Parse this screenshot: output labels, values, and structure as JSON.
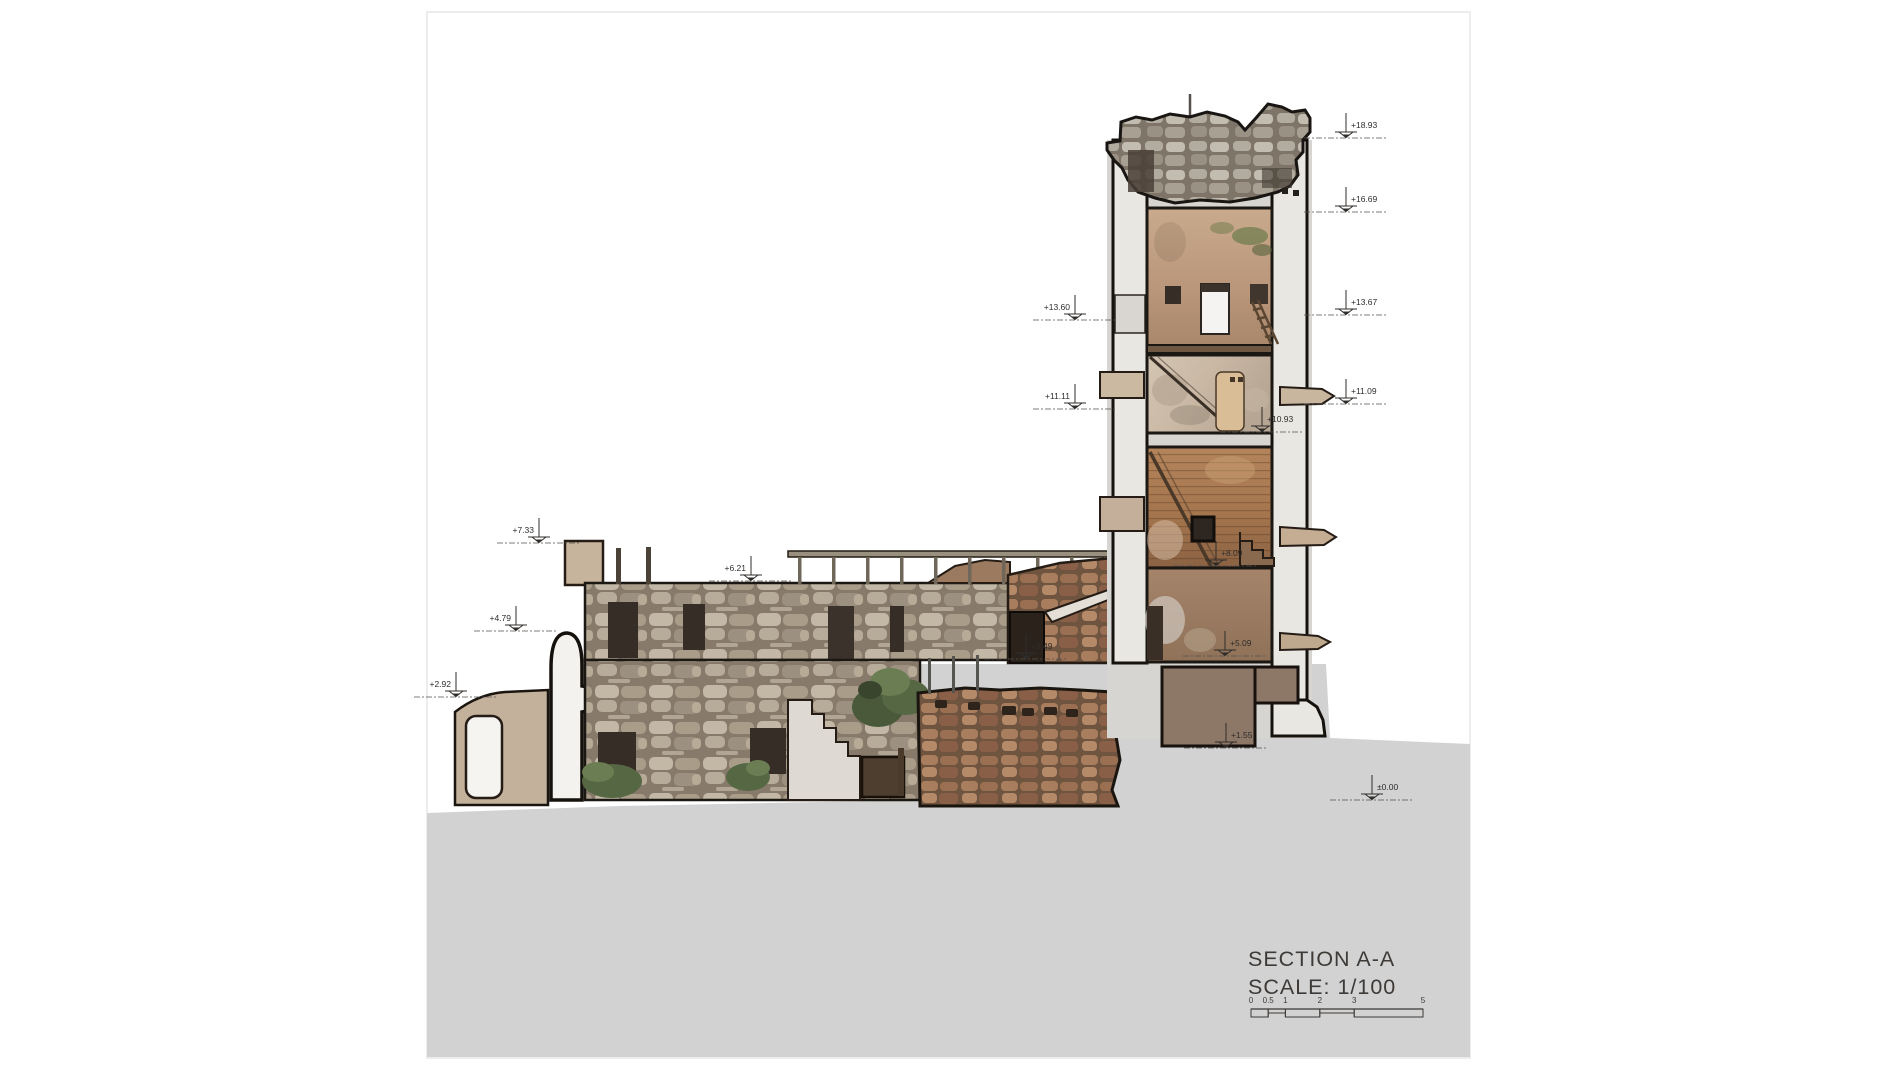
{
  "drawing": {
    "title": "SECTION A-A",
    "scale_label": "SCALE: 1/100",
    "scale_bar": {
      "labels": [
        "0",
        "0.5",
        "1",
        "2",
        "3",
        "5"
      ],
      "meters": [
        0,
        0.5,
        1,
        2,
        3,
        5
      ]
    }
  },
  "elevation_markers": [
    {
      "value": "+18.93",
      "x": 1346,
      "y": 137,
      "text_side": "right"
    },
    {
      "value": "+16.69",
      "x": 1346,
      "y": 211,
      "text_side": "right"
    },
    {
      "value": "+13.67",
      "x": 1346,
      "y": 314,
      "text_side": "right"
    },
    {
      "value": "+11.09",
      "x": 1346,
      "y": 403,
      "text_side": "right"
    },
    {
      "value": "+13.60",
      "x": 1075,
      "y": 319,
      "text_side": "left"
    },
    {
      "value": "+11.11",
      "x": 1075,
      "y": 408,
      "text_side": "left"
    },
    {
      "value": "+10.93",
      "x": 1262,
      "y": 431,
      "text_side": "right"
    },
    {
      "value": "+8.09",
      "x": 1216,
      "y": 565,
      "text_side": "right"
    },
    {
      "value": "+7.33",
      "x": 539,
      "y": 542,
      "text_side": "left"
    },
    {
      "value": "+6.21",
      "x": 751,
      "y": 580,
      "text_side": "left"
    },
    {
      "value": "+5.09",
      "x": 1225,
      "y": 655,
      "text_side": "right"
    },
    {
      "value": "+4.79",
      "x": 516,
      "y": 630,
      "text_side": "left"
    },
    {
      "value": "+3.49",
      "x": 1026,
      "y": 658,
      "text_side": "right"
    },
    {
      "value": "+2.92",
      "x": 456,
      "y": 696,
      "text_side": "left"
    },
    {
      "value": "+1.55",
      "x": 1226,
      "y": 747,
      "text_side": "right"
    },
    {
      "value": "±0.00",
      "x": 1372,
      "y": 799,
      "text_side": "right"
    }
  ],
  "colors": {
    "ground": "#d2d2d2",
    "outline": "#1b1713",
    "cut_wall": "#e9e7e2",
    "stone_light": "#b3a793",
    "rubble_red": "#9a6f52",
    "plaster_tan": "#c1a183",
    "wood_brown": "#a07a55",
    "foundation": "#8d7767",
    "vegetation": "#5f6f44",
    "marker_ink": "#2f2d2b"
  }
}
